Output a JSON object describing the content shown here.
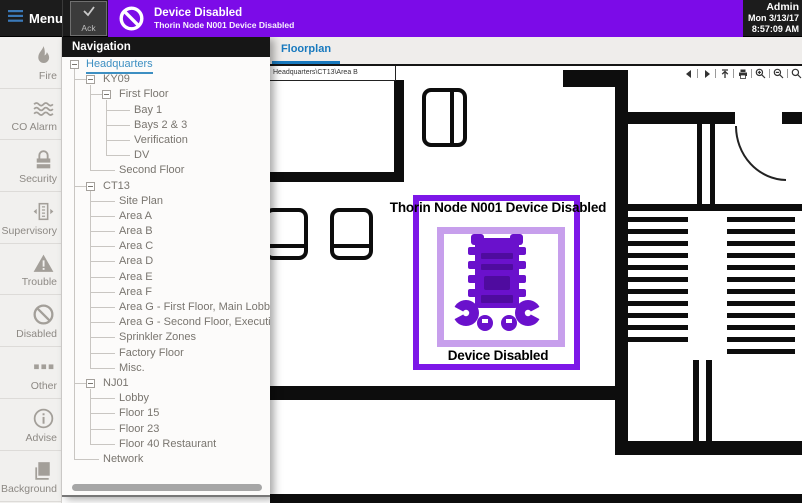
{
  "topbar": {
    "menu_label": "Menu",
    "ack_label": "Ack",
    "alert": {
      "title": "Device Disabled",
      "subtitle": "Thorin Node N001 Device Disabled"
    },
    "status": {
      "user": "Admin",
      "date": "Mon 3/13/17",
      "time": "8:57:09 AM"
    }
  },
  "sidebar": {
    "items": [
      {
        "label": "Fire",
        "icon": "fire-icon"
      },
      {
        "label": "CO Alarm",
        "icon": "co-alarm-icon"
      },
      {
        "label": "Security",
        "icon": "security-icon"
      },
      {
        "label": "Supervisory",
        "icon": "supervisory-icon"
      },
      {
        "label": "Trouble",
        "icon": "trouble-icon"
      },
      {
        "label": "Disabled",
        "icon": "disabled-icon"
      },
      {
        "label": "Other",
        "icon": "other-icon"
      },
      {
        "label": "Advise",
        "icon": "advise-icon"
      },
      {
        "label": "Background",
        "icon": "background-icon"
      }
    ]
  },
  "navigation": {
    "title": "Navigation",
    "tree": [
      {
        "label": "Headquarters",
        "level": 0,
        "expander": true,
        "selected": true
      },
      {
        "label": "KY09",
        "level": 1,
        "expander": true
      },
      {
        "label": "First Floor",
        "level": 2,
        "expander": true
      },
      {
        "label": "Bay 1",
        "level": 3
      },
      {
        "label": "Bays 2 & 3",
        "level": 3
      },
      {
        "label": "Verification",
        "level": 3
      },
      {
        "label": "DV",
        "level": 3
      },
      {
        "label": "Second Floor",
        "level": 2
      },
      {
        "label": "CT13",
        "level": 1,
        "expander": true
      },
      {
        "label": "Site Plan",
        "level": 2
      },
      {
        "label": "Area A",
        "level": 2
      },
      {
        "label": "Area B",
        "level": 2
      },
      {
        "label": "Area C",
        "level": 2
      },
      {
        "label": "Area D",
        "level": 2
      },
      {
        "label": "Area E",
        "level": 2
      },
      {
        "label": "Area F",
        "level": 2
      },
      {
        "label": "Area G - First Floor, Main Lobby",
        "level": 2
      },
      {
        "label": "Area G - Second Floor, Executive Suites",
        "level": 2
      },
      {
        "label": "Sprinkler Zones",
        "level": 2
      },
      {
        "label": "Factory Floor",
        "level": 2
      },
      {
        "label": "Misc.",
        "level": 2
      },
      {
        "label": "NJ01",
        "level": 1,
        "expander": true
      },
      {
        "label": "Lobby",
        "level": 2
      },
      {
        "label": "Floor 15",
        "level": 2
      },
      {
        "label": "Floor 23",
        "level": 2
      },
      {
        "label": "Floor 40 Restaurant",
        "level": 2
      },
      {
        "label": "Network",
        "level": 1
      }
    ]
  },
  "main": {
    "tab_label": "Floorplan",
    "breadcrumb": "Headquarters\\CT13\\Area B",
    "toolbar": [
      {
        "name": "back",
        "icon": "back-icon"
      },
      {
        "name": "forward",
        "icon": "forward-icon"
      },
      {
        "name": "up",
        "icon": "up-icon"
      },
      {
        "name": "print",
        "icon": "print-icon"
      },
      {
        "name": "zoom-in",
        "icon": "zoom-in-icon"
      },
      {
        "name": "zoom-out",
        "icon": "zoom-out-icon"
      },
      {
        "name": "zoom-fit",
        "icon": "zoom-fit-icon"
      }
    ],
    "overlay": {
      "top_label": "Thorin Node N001 Device Disabled",
      "bottom_label": "Device Disabled"
    },
    "colors": {
      "alert_purple": "#7c0be8",
      "highlight_outer": "#7d17e8",
      "highlight_inner": "#c79fec",
      "device_purple": "#6a11cc",
      "tab_blue": "#1879be",
      "tree_selected_blue": "#3d8fc2"
    }
  }
}
